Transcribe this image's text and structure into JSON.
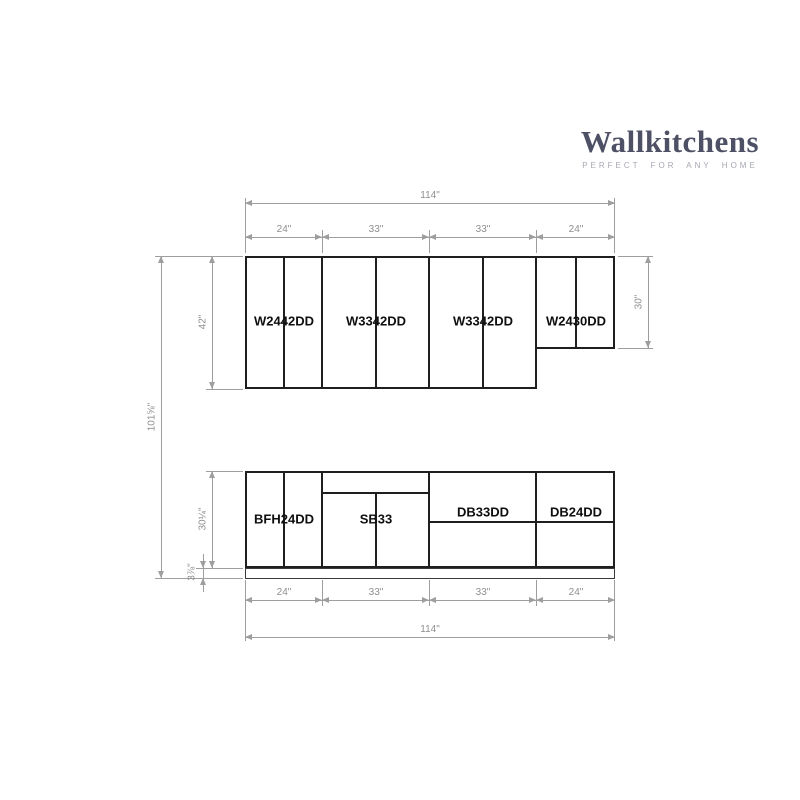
{
  "logo": {
    "brand": "Wallkitchens",
    "tagline": "PERFECT FOR ANY HOME"
  },
  "colors": {
    "brand_text": "#4e5166",
    "tagline_text": "#a6a8b2",
    "cabinet_line": "#1f1f1f",
    "dimension_line": "#9e9e9e",
    "dimension_text": "#8f8f8f",
    "cabinet_label_text": "#0f0f0f",
    "background": "#ffffff"
  },
  "wall_cabinets": [
    {
      "code": "W2442DD"
    },
    {
      "code": "W3342DD"
    },
    {
      "code": "W3342DD"
    },
    {
      "code": "W2430DD"
    }
  ],
  "base_cabinets": [
    {
      "code": "BFH24DD"
    },
    {
      "code": "SB33"
    },
    {
      "code": "DB33DD"
    },
    {
      "code": "DB24DD"
    }
  ],
  "dims": {
    "top": {
      "overall": "114\"",
      "segments": [
        "24\"",
        "33\"",
        "33\"",
        "24\""
      ]
    },
    "bottom": {
      "overall": "114\"",
      "segments": [
        "24\"",
        "33\"",
        "33\"",
        "24\""
      ]
    },
    "left": {
      "overall_height": "101⅝\"",
      "wall_cabinet_height": "42\"",
      "base_cabinet_height": "30¼\"",
      "toe_kick_height": "3⅞\""
    },
    "right": {
      "corner_wall_cabinet_height": "30\""
    }
  }
}
